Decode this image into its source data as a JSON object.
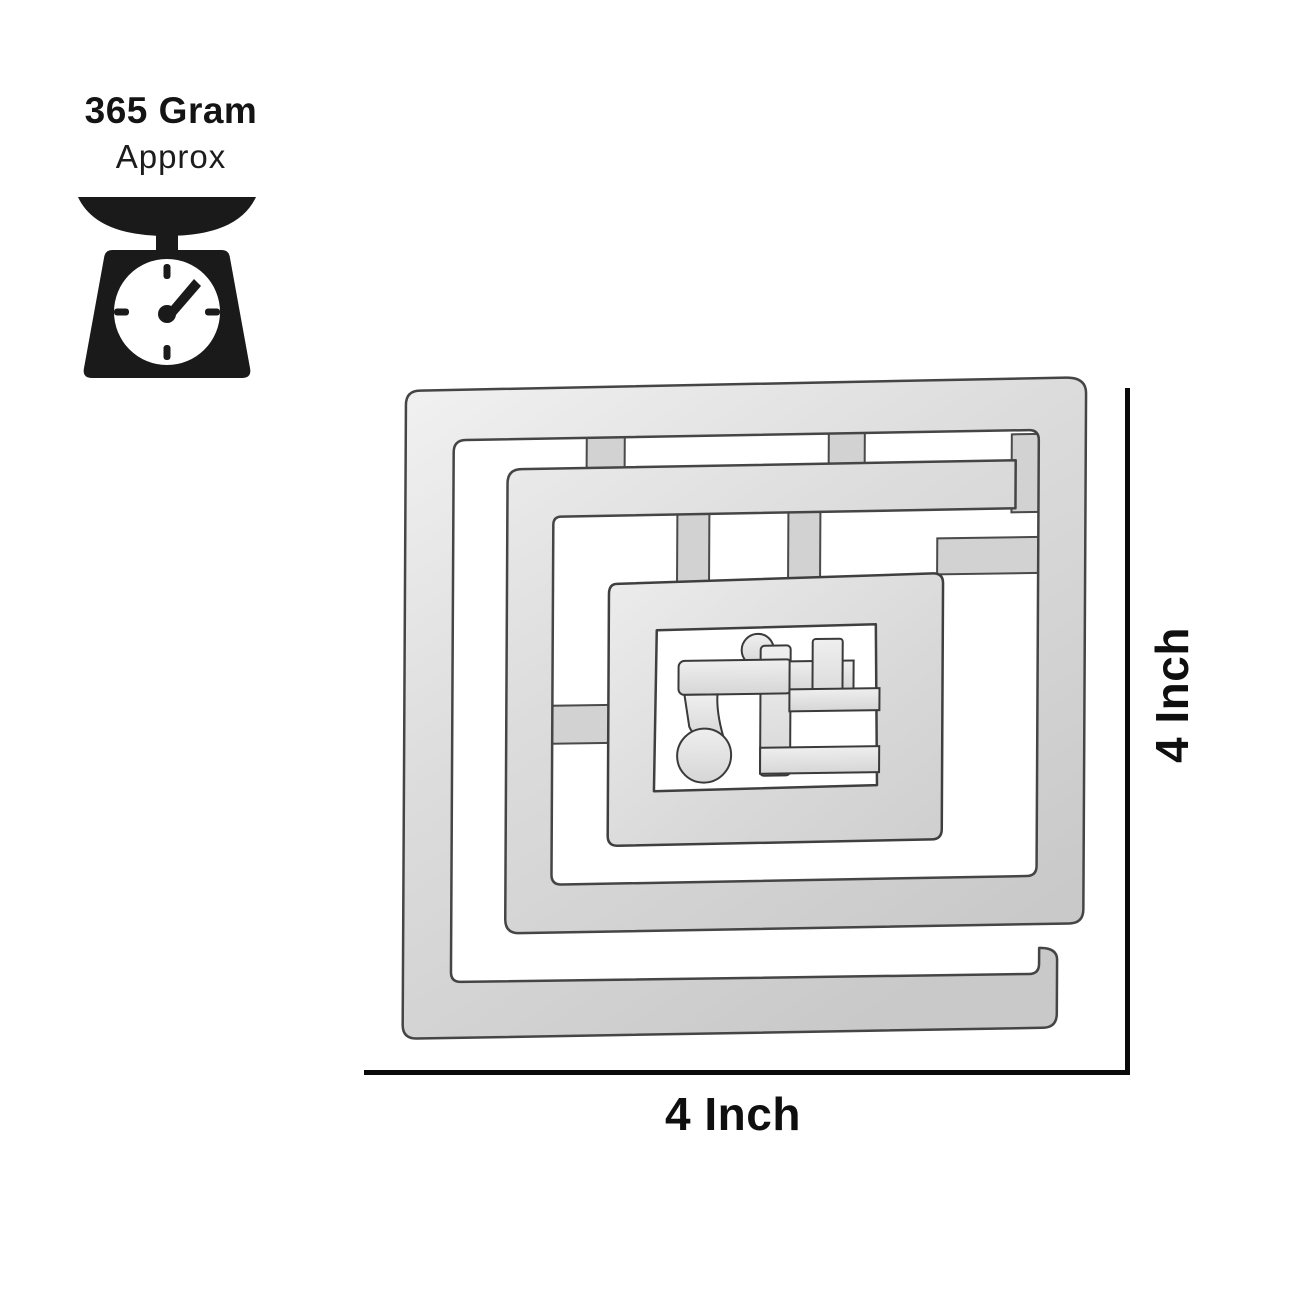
{
  "weight_badge": {
    "value": "365 Gram",
    "qualifier": "Approx"
  },
  "dimensions": {
    "width": "4 Inch",
    "height": "4 Inch"
  },
  "icons": {
    "scale": "kitchen-scale-icon",
    "center_symbol": "devanagari-glyph-cutout"
  },
  "colors": {
    "background": "#ffffff",
    "text": "#141414",
    "dimension_line": "#0a0a0a",
    "icon": "#1a1a1a",
    "metal_light": "#f1f1f1",
    "metal_mid": "#d8d8d8",
    "metal_shadow": "#c3c3c3",
    "metal_edge": "#3f3f3f"
  }
}
